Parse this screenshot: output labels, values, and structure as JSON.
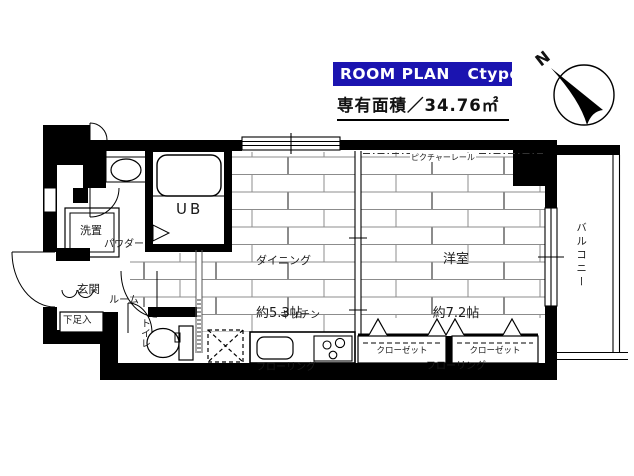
{
  "header": {
    "badge_label": "ROOM PLAN   Ctype",
    "badge_bg_color": "#1b14b0",
    "area_label": "専有面積／34.76㎡",
    "compass_n": "N"
  },
  "labels": {
    "dining_name": "ダイニング",
    "dining_size": "約5.3帖",
    "dining_floor": "フローリング",
    "bedroom_name": "洋室",
    "bedroom_size": "約7.2帖",
    "bedroom_floor": "フローリング",
    "kitchen": "キッチン",
    "picture_rail": "ピクチャーレール",
    "unit_bath": "UB",
    "powder_room_line1": "パウダー",
    "powder_room_line2": "ルーム",
    "washer_space": "洗置",
    "entrance": "玄関",
    "shoe_cabinet": "下足入",
    "toilet": "トイレ",
    "balcony": "バルコニー",
    "closet_left": "クローゼット",
    "closet_right": "クローゼット"
  }
}
